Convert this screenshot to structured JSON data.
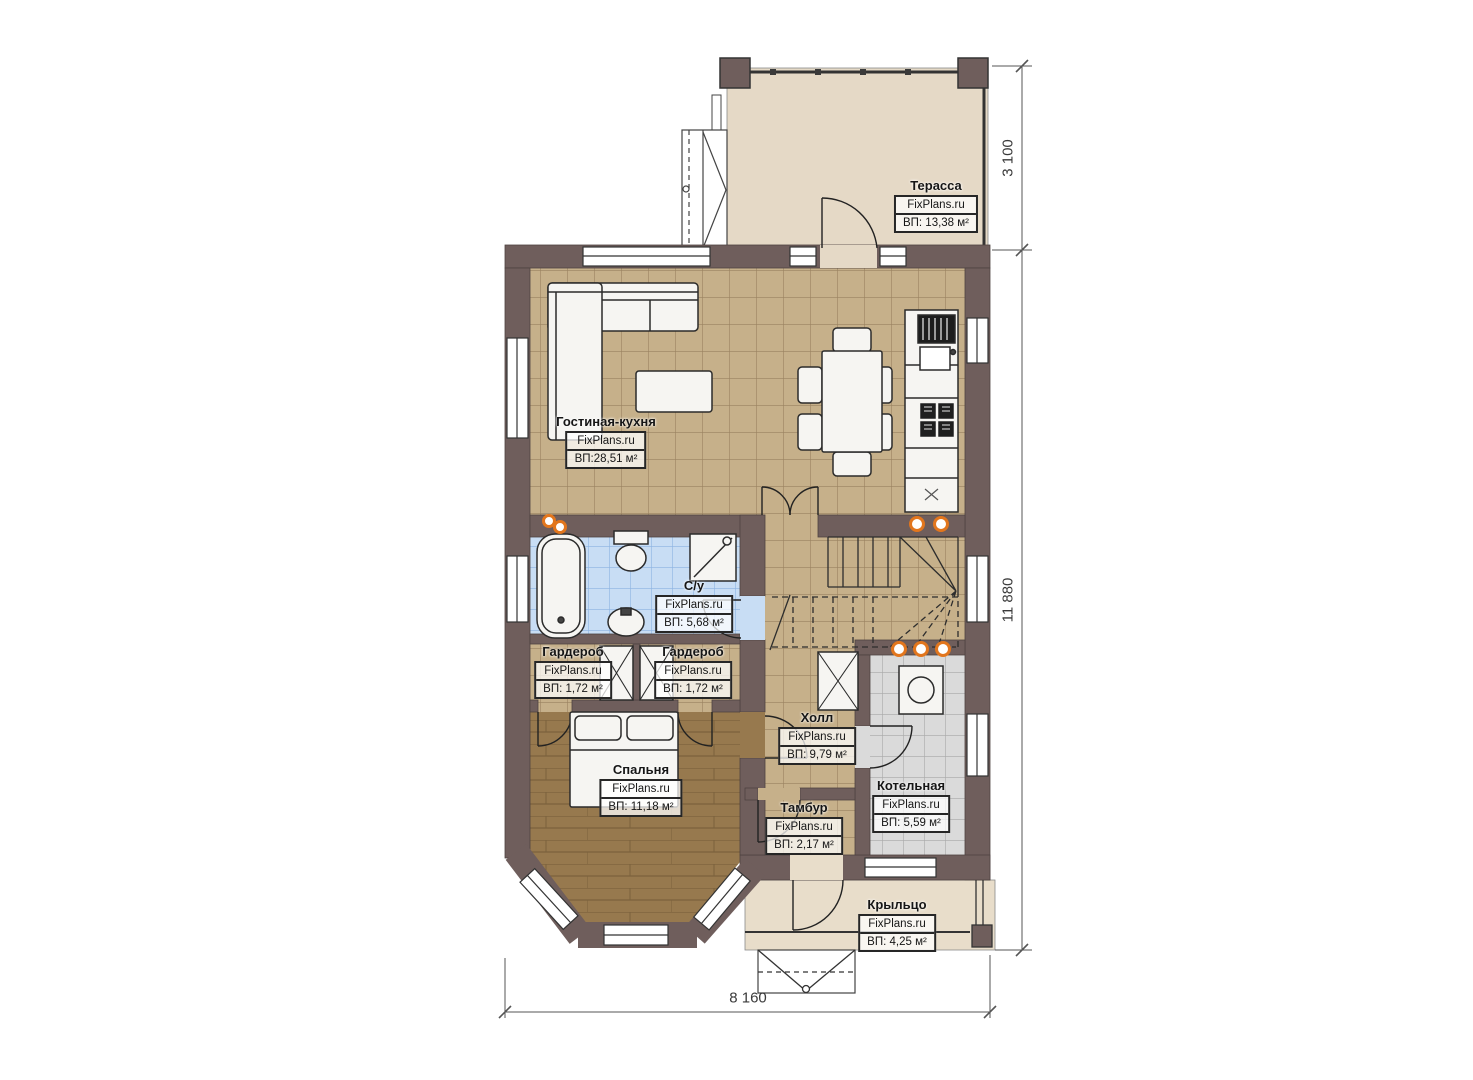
{
  "branding": {
    "site": "FixPlans.ru"
  },
  "rooms": [
    {
      "id": "terrace",
      "name": "Терасса",
      "site": "FixPlans.ru",
      "area": "ВП: 13,38 м²"
    },
    {
      "id": "living-kitchen",
      "name": "Гостиная-кухня",
      "site": "FixPlans.ru",
      "area": "ВП:28,51 м²"
    },
    {
      "id": "bathroom",
      "name": "С/у",
      "site": "FixPlans.ru",
      "area": "ВП: 5,68 м²"
    },
    {
      "id": "wardrobe-left",
      "name": "Гардероб",
      "site": "FixPlans.ru",
      "area": "ВП: 1,72 м²"
    },
    {
      "id": "wardrobe-right",
      "name": "Гардероб",
      "site": "FixPlans.ru",
      "area": "ВП: 1,72 м²"
    },
    {
      "id": "bedroom",
      "name": "Спальня",
      "site": "FixPlans.ru",
      "area": "ВП: 11,18 м²"
    },
    {
      "id": "hall",
      "name": "Холл",
      "site": "FixPlans.ru",
      "area": "ВП: 9,79 м²"
    },
    {
      "id": "vestibule",
      "name": "Тамбур",
      "site": "FixPlans.ru",
      "area": "ВП: 2,17 м²"
    },
    {
      "id": "boiler-room",
      "name": "Котельная",
      "site": "FixPlans.ru",
      "area": "ВП: 5,59 м²"
    },
    {
      "id": "porch",
      "name": "Крыльцо",
      "site": "FixPlans.ru",
      "area": "ВП: 4,25 м²"
    }
  ],
  "dimensions": {
    "terrace_depth": "3 100",
    "house_length": "11 880",
    "house_width": "8 160"
  },
  "colors": {
    "wall": "#6f5e5c",
    "floor_tile": "#c6b08a",
    "floor_wood": "#97794e",
    "floor_bath": "#c8ddf4",
    "floor_boiler": "#dadada",
    "floor_terrace": "#e5d9c6",
    "floor_porch": "#e8ddca",
    "radiator": "#e2761d"
  }
}
